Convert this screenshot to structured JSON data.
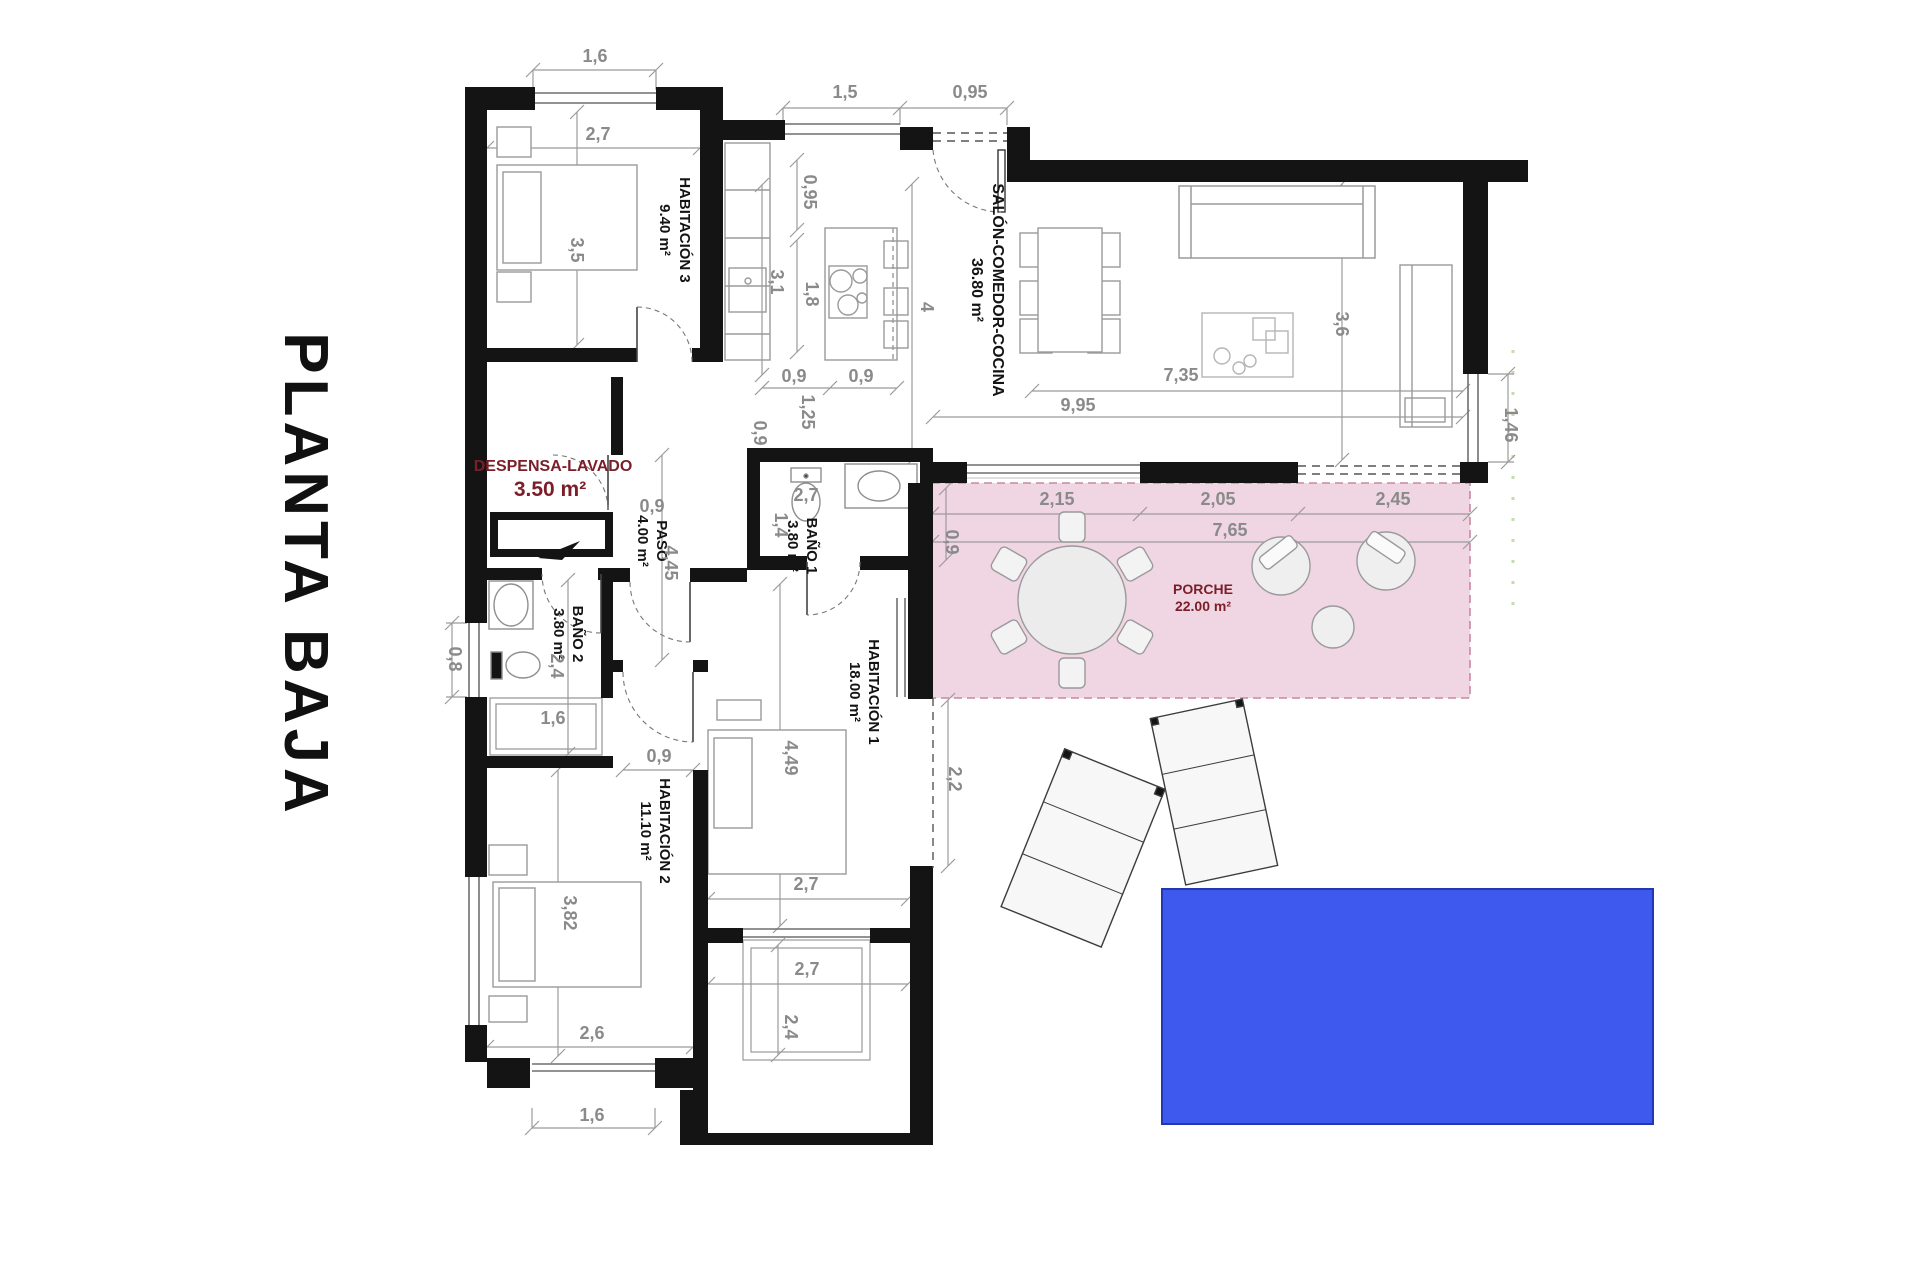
{
  "title": "PLANTA BAJA",
  "rooms": {
    "hab3": {
      "name": "HABITACIÓN 3",
      "area": "9.40 m²"
    },
    "salon": {
      "name": "SALÓN-COMEDOR-COCINA",
      "area": "36.80 m²"
    },
    "despensa": {
      "name": "DESPENSA-LAVADO",
      "area": "3.50 m²"
    },
    "paso": {
      "name": "PASO",
      "area": "4.00 m²"
    },
    "bano1": {
      "name": "BAÑO 1",
      "area": "3.80 m²"
    },
    "bano2": {
      "name": "BAÑO 2",
      "area": "3.80 m²"
    },
    "hab1": {
      "name": "HABITACIÓN 1",
      "area": "18.00 m²"
    },
    "hab2": {
      "name": "HABITACIÓN 2",
      "area": "11.10 m²"
    },
    "porche": {
      "name": "PORCHE",
      "area": "22.00 m²"
    }
  },
  "dimensions": {
    "hab3_window": "1,6",
    "hab3_width": "2,7",
    "hab3_depth": "3,5",
    "kitchen_window": "1,5",
    "entry_door": "0,95",
    "kitchen_depth": "0,95",
    "kitchen_run": "3,1",
    "island_length": "1,8",
    "salon_span": "4",
    "island_clear_left": "0,9",
    "island_clear_right": "0,9",
    "hall_width": "0,9",
    "hall_length": "1,25",
    "salon_length": "9,95",
    "salon_inner_length": "7,35",
    "salon_depth": "3,6",
    "window_right": "1,46",
    "bano1_width": "2,7",
    "bano1_depth": "1,4",
    "porch_offset": "0,9",
    "porch_seg1": "2,15",
    "porch_seg2": "2,05",
    "porch_seg3": "2,45",
    "porch_length": "7,65",
    "paso_door": "0,9",
    "paso_length": "4,45",
    "bano2_length": "2,4",
    "closet_width": "1,6",
    "window_left": "0,8",
    "hab2_door": "0,9",
    "hab1_length": "4,49",
    "hab1_width": "2,7",
    "side_gap": "2,2",
    "hab2_length": "3,82",
    "hab2_width": "2,6",
    "hab2_window": "1,6",
    "patio_width": "2,7",
    "patio_length": "2,4"
  },
  "colors": {
    "wall": "#141414",
    "porch_fill": "#f0d5e3",
    "pool_fill": "#3d59ee",
    "label_accent": "#7b1e28",
    "dimension_text": "#8a8a8a"
  }
}
